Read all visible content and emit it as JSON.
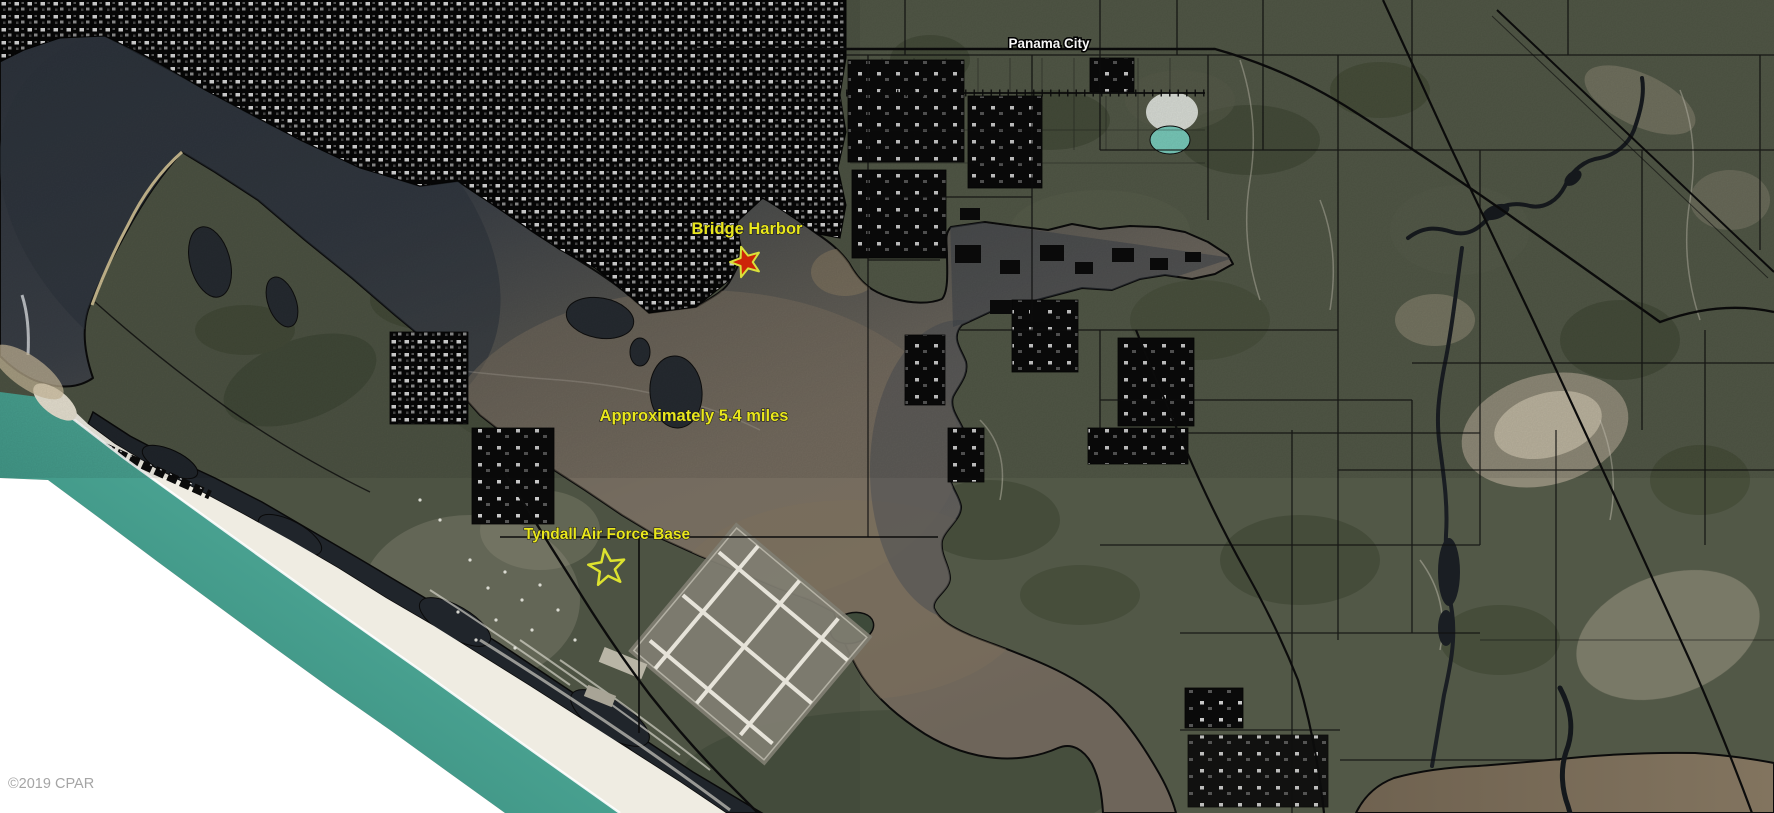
{
  "map": {
    "type": "satellite-aerial-photo",
    "labels": {
      "panama_city": "Panama City",
      "bridge_harbor": "Bridge Harbor",
      "distance": "Approximately 5.4 miles",
      "tyndall": "Tyndall Air Force Base"
    },
    "watermark": "©2019 CPAR",
    "icons": {
      "bridge_harbor_star": "filled-star-marker",
      "tyndall_star": "hollow-star-marker"
    },
    "colors": {
      "label_yellow": "#e9e71d",
      "label_white": "#f7f7f7",
      "watermark_gray": "#a5a5a5",
      "star_red": "#cd2408",
      "star_outline": "#dde22f",
      "gulf_teal": "#4aa392",
      "bay_murky": "#6d675e",
      "bay_dark": "#2e343d",
      "land_olive": "#4d5343",
      "urban_black": "#070707"
    }
  }
}
